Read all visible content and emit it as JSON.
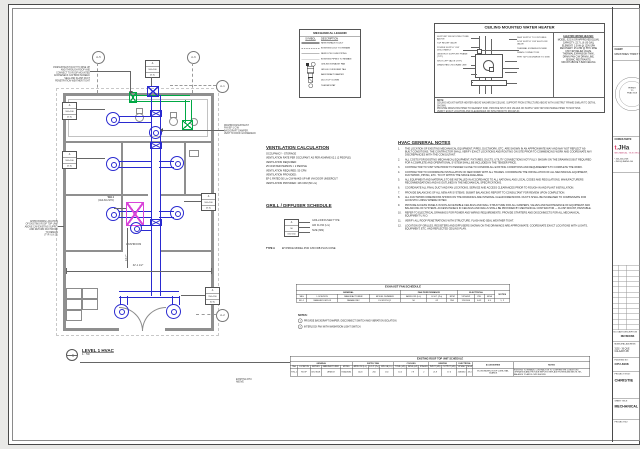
{
  "plan": {
    "callout": {
      "num": "1",
      "title": "LEVEL 1 HVAC",
      "scale": "1 : 50"
    },
    "grid_bubbles": {
      "a5": "A-5",
      "a6": "A-6",
      "a1": "A-1",
      "a2": "A-2"
    },
    "notes": {
      "top_left": [
        "150Ø EXHAUST DUCT TO RISE UP",
        "AND THROUGH ROOF AND",
        "CONNECT TO ROOF MOUNTED",
        "GOOSENECK C/W BIRD SCREEN.",
        "SEAL AND FLASH DUCT",
        "PENETRATION WEATHER TIGHT"
      ],
      "mid_left": [
        "APPROXIMATE LOCATION",
        "OF EXISTING ROOF TOP UNIT",
        "ABOVE C/W EXISTING SUPPLY",
        "AND RETURN DUCTWORK",
        "TO REMAIN",
        "(TYP. U.N.O.)"
      ],
      "mid_right": [
        "WASHROOM EXHAUST",
        "FAN EF-1 C/W",
        "BACKDRAFT DAMPER.",
        "VENT TO ROOF GOOSENECK"
      ],
      "bottom": [
        "EXISTING RTU",
        "ABOVE"
      ]
    },
    "labels": {
      "washroom": "WASHROOM",
      "wh1": "WH-1",
      "wh2": "(CEILING MTD)",
      "dim_h": "32'-1 1/2″",
      "dim_v": "14'-7″"
    },
    "tags": [
      {
        "type": "A",
        "size": "100×100",
        "flow": "25 l/s"
      },
      {
        "type": "A",
        "size": "100×100",
        "flow": "25 l/s"
      },
      {
        "type": "A",
        "size": "100×100",
        "flow": "25 l/s"
      },
      {
        "type": "A",
        "size": "100×100",
        "flow": "25 l/s"
      },
      {
        "type": "A",
        "size": "150×150",
        "flow": "50 l/s"
      }
    ]
  },
  "legend": {
    "title": "MECHANICAL LEGEND",
    "col_symbol": "SYMBOL",
    "col_desc": "DESCRIPTION",
    "rows": [
      {
        "sym": "line-heavy",
        "label": "NEW EXHAUST DUCT"
      },
      {
        "sym": "line-dashdot",
        "label": "EXISTING DUCT TO REMAIN"
      },
      {
        "sym": "line-thin",
        "label": "NEW DCW / DHW PIPING"
      },
      {
        "sym": "line-thin2",
        "label": "EXISTING PIPING TO REMAIN"
      },
      {
        "sym": "glyph-fan",
        "label": "CEILING EXHAUST FAN"
      },
      {
        "sym": "glyph-tag",
        "label": "GRILLE / DIFFUSER TAG"
      },
      {
        "sym": "glyph-box",
        "label": "BACKDRAFT DAMPER"
      },
      {
        "sym": "glyph-box2",
        "label": "DUCT UP / DOWN"
      },
      {
        "sym": "glyph-circle",
        "label": "THERMOSTAT"
      }
    ]
  },
  "wh_detail": {
    "title": "CEILING MOUNTED WATER HEATER",
    "left_callouts": [
      "SUPPORT FROM STRUCTURE ABOVE",
      "T&P RELIEF VALVE",
      "POWER SUPPLY C/W DISCONNECT",
      "UNISTRUT SUPPORT FRAME (TYP.)",
      "SHUT-OFF VALVE (TYP.)",
      "DRAIN PAN C/W DRAIN LINE"
    ],
    "right_callouts": [
      "DHW SUPPLY TO FIXTURES",
      "DCW SUPPLY C/W SHUT-OFF VALVE",
      "THERMAL EXPANSION TANK",
      "DRAIN CONNECTION",
      "PIPE T&P DISCHARGE TO SINK"
    ],
    "spec_title": "ELECTRIC WATER HEATER:",
    "spec_lines": [
      "MODEL: EJC-6 OR APPROVED EQUAL",
      "CAPACITY: 22.7 L (6 US GAL)",
      "ELEMENT: 1.5 kW @ 120V/1PH",
      "RECOVERY: 25 L/HR @ 55°C RISE",
      "C/W T&P RELIEF VALVE,",
      "THERMAL EXPANSION TANK,",
      "DRAIN PAN C/W DRAIN LINE,",
      "SEISMIC RESTRAINTS.",
      "MOUNT ABOVE T-BAR CEILING"
    ],
    "note_label": "NOTE:",
    "note_lines": [
      "CEILING MOUNT WATER HEATER ABOVE WASHROOM CEILING. SUPPORT FROM STRUCTURE ABOVE WITH UNISTRUT FRAME SIMILAR TO DETAIL SHOWN.",
      "PROVIDE DRAIN PAN PIPED TO NEAREST SINK. PROVIDE SHUT-OFF VALVES ON SUPPLY AND T&P DISCHARGE PIPED TO MOP SINK.",
      "VERIFY EXACT LOCATION AND CLEARANCES ON SITE PRIOR TO ROUGH-IN."
    ]
  },
  "vent_calc": {
    "title": "VENTILATION CALCULATION",
    "lines": [
      "OCCUPANCY - STORAGE",
      "VENTILATION RATE PER OCCUPANT: AS PER ASHRAE 62.1 (2 PEOPLE)",
      "VENTILATION REQUIRED:",
      "25 CFM PER PERSON × 2 PEOPLE",
      "VENTILATION REQUIRED: 50 CFM",
      "VENTILATION PROVIDED:",
      "EF-1 RATED 50 L/s C/W MAKE-UP AIR VIA DOOR UNDERCUT",
      "VENTILATION PROVIDED: 106 CFM (50 L/s)"
    ]
  },
  "grille_schedule": {
    "title": "GRILL / DIFFUSER SCHEDULE",
    "tag_example": {
      "type": "A",
      "flow": "50",
      "size": "150×150"
    },
    "labels": [
      "GRILL/DIFFUSER TYPE",
      "AIR FLOW (L/s)",
      "SIZE (MM)"
    ],
    "type_name": "TYPE A",
    "type_desc": "EH PRICE MODEL PCD C/W FDB PLUS CONE"
  },
  "hvac_notes": {
    "title": "HVAC GENERAL NOTES",
    "items": [
      {
        "n": "1.",
        "t": "THE LOCATION OF EXISTING MECHANICAL EQUIPMENT, PIPES, DUCTWORK, ETC. ARE SHOWN IN AN APPROXIMATE WAY AND MAY NOT REFLECT AS-BUILT CONDITIONS. THE CONTRACTOR SHALL VERIFY EXACT LOCATIONS AND ROUTING ON SITE PRIOR TO COMMENCING WORK AND COORDINATE ANY DISCREPANCIES WITH THE CONSULTANT."
      },
      {
        "n": "2.",
        "t": "ALL COSTS FOR EXISTING MECHANICAL EQUIPMENT, FIXTURES, DUCTS, UTILITY CONNECTIONS NOT FULLY SHOWN ON THE DRAWINGS BUT REQUIRED FOR A COMPLETE AND OPERATIONAL SYSTEM SHALL BE INCLUDED IN THE TENDER PRICE."
      },
      {
        "n": "3.",
        "t": "CONTRACTOR TO VISIT SITE PRIOR TO TENDER CLOSE TO CONFIRM ALL EXISTING CONDITIONS AND REQUIREMENTS TO COMPLETE THE WORK."
      },
      {
        "n": "4.",
        "t": "CONTRACTOR TO COORDINATE INSTALLATION OF NEW WORK WITH ALL TRADES. COORDINATE THE INSTALLATION OF ALL MECHANICAL EQUIPMENT, DUCTWORK, PIPING, ETC. TO FIT WITHIN THE SPACE AVAILABLE."
      },
      {
        "n": "5.",
        "t": "ALL EQUIPMENT AND MATERIALS TO BE INSTALLED IN ACCORDANCE TO ALL NATIONAL AND LOCAL CODES AND REGULATIONS, MANUFACTURERS RECOMMENDATIONS AND AS OUTLINED IN THE MECHANICAL SPECIFICATIONS."
      },
      {
        "n": "6.",
        "t": "COORDINATE ALL FINAL DUCT AND FAN LOCATIONS, SERVICE AND ACCESS CLEARANCES PRIOR TO ROUGH-IN AND PLANT INSTALLATION."
      },
      {
        "n": "7.",
        "t": "PROVIDE BALANCING OF ALL NEW AIR SYSTEMS. SUBMIT BALANCING REPORT TO CONSULTANT FOR REVIEW UPON COMPLETION."
      },
      {
        "n": "8.",
        "t": "ALL DUCTWORK DIMENSIONS SHOWN ON THE DRAWINGS ARE INTERNAL CLEAR DIMENSIONS. DUCTS SHALL BE INCREASED TO COMPENSATE FOR ACOUSTIC LINING WHERE NOTED."
      },
      {
        "n": "9.",
        "t": "PROVIDE ACCESS PANELS IN NON-ACCESSIBLE CEILINGS AND WALL STRUCTURE FOR ALL DAMPERS, VALVES AND MAINTENANCE OF EQUIPMENT AND BALANCING OF SYSTEMS. ACCESS PANELS IN CEILINGS AND WALLS SHALL BE PROVIDED BY MECHANICAL CONTRACTOR — FLUSH MOUNT, PAINTABLE."
      },
      {
        "n": "10.",
        "t": "REFER TO ELECTRICAL DRAWINGS FOR POWER AND WIRING REQUIREMENTS. PROVIDE STARTERS AND DISCONNECTS FOR ALL MECHANICAL EQUIPMENT U.N.O."
      },
      {
        "n": "11.",
        "t": "VERIFY ALL ROOF PENETRATIONS WITH STRUCTURE. FLASH AND SEAL WEATHER TIGHT."
      },
      {
        "n": "12.",
        "t": "LOCATION OF GRILLES, REGISTERS AND DIFFUSERS SHOWN ON THE DRAWINGS ARE APPROXIMATE. COORDINATE EXACT LOCATIONS WITH LIGHTS, EQUIPMENT, ETC. AND REFLECTED CEILING PLAN."
      }
    ]
  },
  "fan_schedule": {
    "title": "EXHAUST FAN SCHEDULE",
    "groups": {
      "general": "GENERAL",
      "performance": "FAN PERFORMANCE",
      "electrical": "ELECTRICAL"
    },
    "notes_col": "NOTES",
    "columns": [
      "TAG",
      "LOCATION",
      "MANUFACTURER",
      "MODEL NUMBER",
      "AIRFLOW (L/s)",
      "E.S.P. (Pa)",
      "RPM",
      "V/PH/HZ",
      "KW",
      "MCA"
    ],
    "row": [
      "EF-1",
      "WASHROOM 103",
      "PANASONIC",
      "FV-0511VQ1",
      "50",
      "62",
      "950",
      "120/1/60",
      "0.02",
      "0.5",
      "1, 2"
    ],
    "notes_label": "NOTES:",
    "notes": [
      {
        "n": "1",
        "t": "PROVIDE BACKDRAFT DAMPER, DISCONNECT SWITCH AND VIBRATION ISOLATION."
      },
      {
        "n": "2",
        "t": "INTERLOCK FAN WITH WASHROOM LIGHT SWITCH."
      }
    ]
  },
  "rtu_schedule": {
    "title": "EXISTING ROOF TOP UNIT SCHEDULE",
    "groups": {
      "general": "GENERAL",
      "supply": "SUPPLY FAN",
      "cooling": "COOLING",
      "heating": "HEATING",
      "electrical": "ELECTRICAL",
      "accessories": "ACCESSORIES",
      "notes": "NOTES"
    },
    "columns": [
      "TAG",
      "LOCATION",
      "SERVES",
      "MANUFACTURER",
      "MODEL",
      "AIRFLOW (L/s)",
      "E.S.P. (Pa)",
      "MIN OA (L/s)",
      "TOTAL (kW)",
      "SENS (kW)",
      "STAGES",
      "INPUT (kW)",
      "OUTPUT (kW)",
      "V/PH/HZ",
      "MCA"
    ],
    "row": [
      "RTU-1",
      "ROOF",
      "CRU 8108",
      "LENNOX",
      "KGA036S4",
      "1420",
      "250",
      "150",
      "10.5",
      "7.9",
      "2",
      "21.9",
      "17.6",
      "208/3/60",
      "28.4",
      "ECONOMIZER, ROOF CURB, HAIL GUARDS",
      "EXISTING TO REMAIN. CONTRACTOR TO CONFIRM THE CONDITION / OPERATION AND PROVIDE REPORT. REPLACE FILTERS AND BELTS. RE-BALANCE TO AIR FLOWS SHOWN."
    ]
  },
  "titleblock": {
    "client_label": "CLIENT:",
    "client_name": "MINISTRIES THRIFT S",
    "seal_lines": [
      "PERMIT",
      "TO",
      "PRACTICE"
    ],
    "consultants_label": "CONSULTANTS:",
    "logo_prefix": "t.",
    "logo_text": "JHa",
    "logo_sub": "MECHANICAL · ELECTRICAL",
    "contact_lines": [
      "• 403-455-0708",
      "• INFO@JHENG.CA"
    ],
    "rev_header": "NO.   DATE   DESCRIPTION",
    "revisions_caption": "REVISIONS",
    "municipal_label": "MUNICIPAL ADDRESS:",
    "municipal_lines": [
      "3102 - 36 QUE",
      "CALGARY AB"
    ],
    "file_label": "FILE/DWG NO:",
    "file_value": "CPU-8108",
    "project_title_label": "PROJECT TITLE:",
    "project_title": "CHRISTIE",
    "sheet_title_label": "SHEET TITLE:",
    "sheet_title": "MECHANICAL",
    "project_no_label": "PROJECT NO:"
  }
}
